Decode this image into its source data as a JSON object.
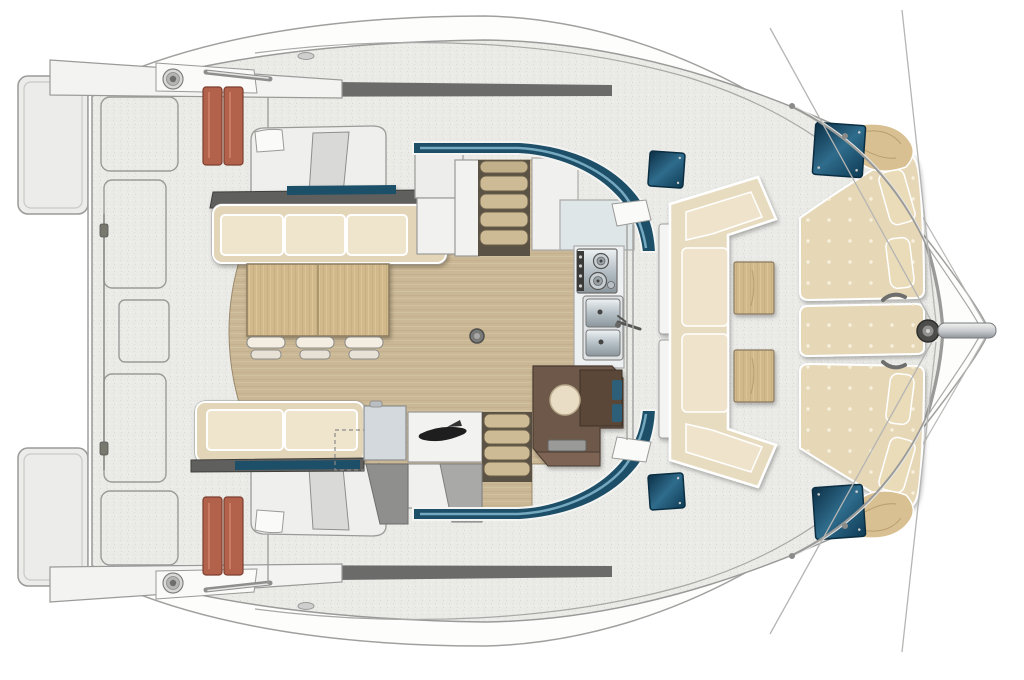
{
  "diagram": {
    "type": "boat-deck-plan",
    "subject": "Catamaran sailing yacht deck and salon floor plan, top-down view, bow pointing right",
    "background": "#ffffff"
  },
  "palette": {
    "hull": "#fdfdfc",
    "deck": "#eaeae7",
    "outline_gray": "#9a9a98",
    "wood_floor": "#cab795",
    "table_wood": "#d2b98c",
    "sofa_frame": "#e3d5b8",
    "cushion": "#efe4cc",
    "cockpit_frame": "#e8dcc0",
    "cockpit_cushion": "#efe3cb",
    "sunpad": "#e6d7b7",
    "pillow": "#eadcb9",
    "corner_cushion": "#d9c092",
    "window_teal": "#1d4f68",
    "window_highlight": "#7fb3ca",
    "hatch": "#0c2f45",
    "hatch_highlight": "#2f6c8c",
    "transom_steps": "#b2614b",
    "counter_dark": "#5f5f5d",
    "nav_brown": "#6e5848",
    "nav_brown_dark": "#5a4738",
    "stool_cream": "#e9ddc5",
    "galley_steel": "#b6c0c6",
    "structure_gray": "#8f8f8d"
  },
  "components": {
    "stern": {
      "swim_platforms": 2,
      "transom_step_columns": 4,
      "deck_hatch_outlines": 5,
      "winches": 2,
      "mooring_rods": 2,
      "lifeline_clamps": 2
    },
    "salon": {
      "forward_sofa_cushions": 3,
      "aft_sofa_cushions": 2,
      "dining_table_panels": 2,
      "bar_stools": 3,
      "companionway_stairs": 2,
      "stair_treads_each": 4,
      "mast_post": 1,
      "helm_seat_consoles": 2
    },
    "galley": {
      "stove_burners": 2,
      "stove_knobs": 4,
      "sink_basins": 2,
      "faucets": 1
    },
    "nav_station": {
      "desks": 1,
      "stools": 1,
      "teal_accent_panels": 2
    },
    "forward_cockpit": {
      "u_sofa_cushions": 4,
      "side_tables": 2,
      "back_panels": 2
    },
    "foredeck": {
      "sun_pad_sections": 3,
      "bolster_pillows": 4,
      "corner_cushions": 2,
      "deck_hatches": 4,
      "window_bands": 2
    },
    "bow": {
      "bowsprit": 1,
      "anchor_hub": 1,
      "cleats": 2,
      "rigging_lines": 4,
      "rail_segments": 2
    }
  }
}
